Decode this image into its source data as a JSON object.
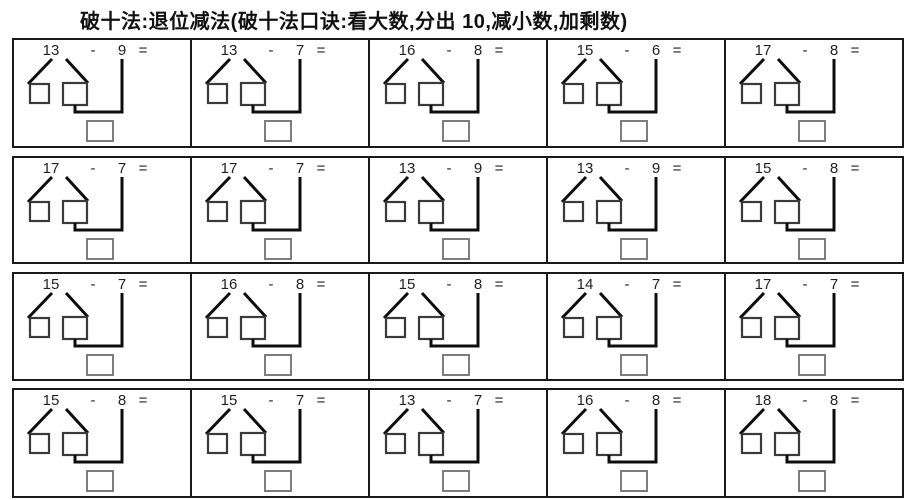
{
  "title": "破十法:退位减法(破十法口诀:看大数,分出 10,减小数,加剩数)",
  "symbols": {
    "minus": "-",
    "equals": "="
  },
  "colors": {
    "background": "#ffffff",
    "grid_border": "#1a1a1a",
    "connector_line": "#0d0d0d",
    "part_box_stroke": "#3a3a3a",
    "answer_box_stroke": "#7d7d7d",
    "text": "#222222"
  },
  "rows": [
    [
      {
        "a": "13",
        "b": "9"
      },
      {
        "a": "13",
        "b": "7"
      },
      {
        "a": "16",
        "b": "8"
      },
      {
        "a": "15",
        "b": "6"
      },
      {
        "a": "17",
        "b": "8"
      }
    ],
    [
      {
        "a": "17",
        "b": "7"
      },
      {
        "a": "17",
        "b": "7"
      },
      {
        "a": "13",
        "b": "9"
      },
      {
        "a": "13",
        "b": "9"
      },
      {
        "a": "15",
        "b": "8"
      }
    ],
    [
      {
        "a": "15",
        "b": "7"
      },
      {
        "a": "16",
        "b": "8"
      },
      {
        "a": "15",
        "b": "8"
      },
      {
        "a": "14",
        "b": "7"
      },
      {
        "a": "17",
        "b": "7"
      }
    ],
    [
      {
        "a": "15",
        "b": "8"
      },
      {
        "a": "15",
        "b": "7"
      },
      {
        "a": "13",
        "b": "7"
      },
      {
        "a": "16",
        "b": "8"
      },
      {
        "a": "18",
        "b": "8"
      }
    ]
  ]
}
